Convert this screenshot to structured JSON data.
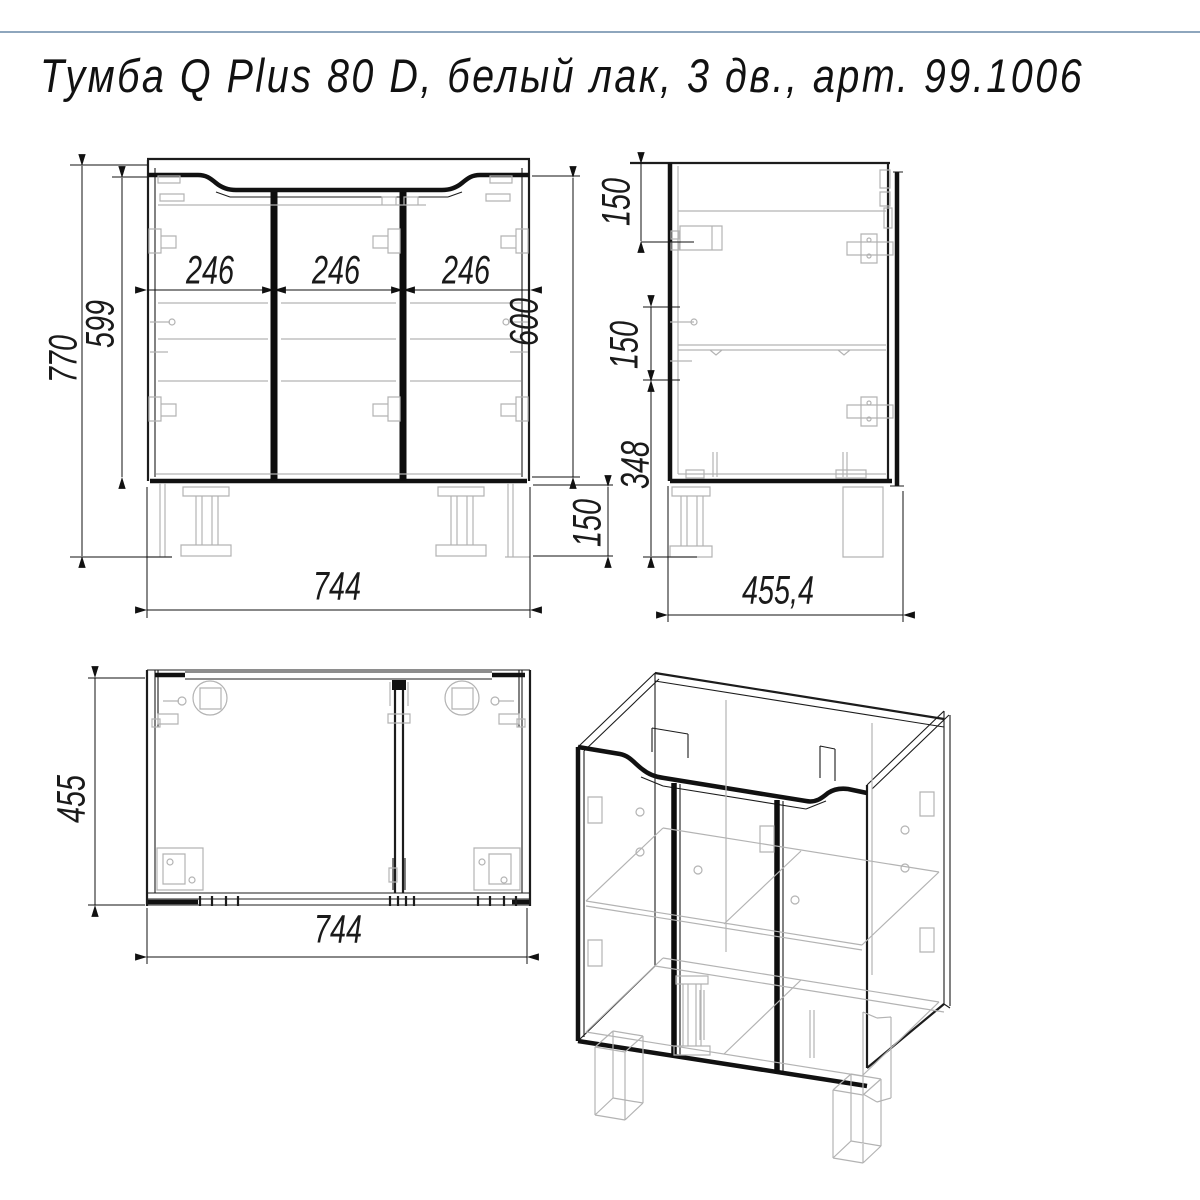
{
  "title": {
    "text": "Тумба Q Plus 80 D,  белый лак,  3 дв.,  арт.  99.1006"
  },
  "colors": {
    "line": "#1c1c1c",
    "hardware_gray": "#b3b3b3",
    "header_rule": "#8ea6bd"
  },
  "views": {
    "front": "front-view",
    "side": "side-view",
    "top": "top-view",
    "iso": "isometric-view"
  },
  "dims": {
    "fv_total_height": "770",
    "fv_inner_height": "599",
    "fv_door1": "246",
    "fv_door2": "246",
    "fv_door3": "246",
    "fv_right_height": "600",
    "fv_leg_height": "150",
    "fv_width": "744",
    "sv_top_offset": "150",
    "sv_mid_spacing": "150",
    "sv_bottom_section": "348",
    "sv_depth": "455,4",
    "tv_depth": "455",
    "tv_width": "744"
  }
}
